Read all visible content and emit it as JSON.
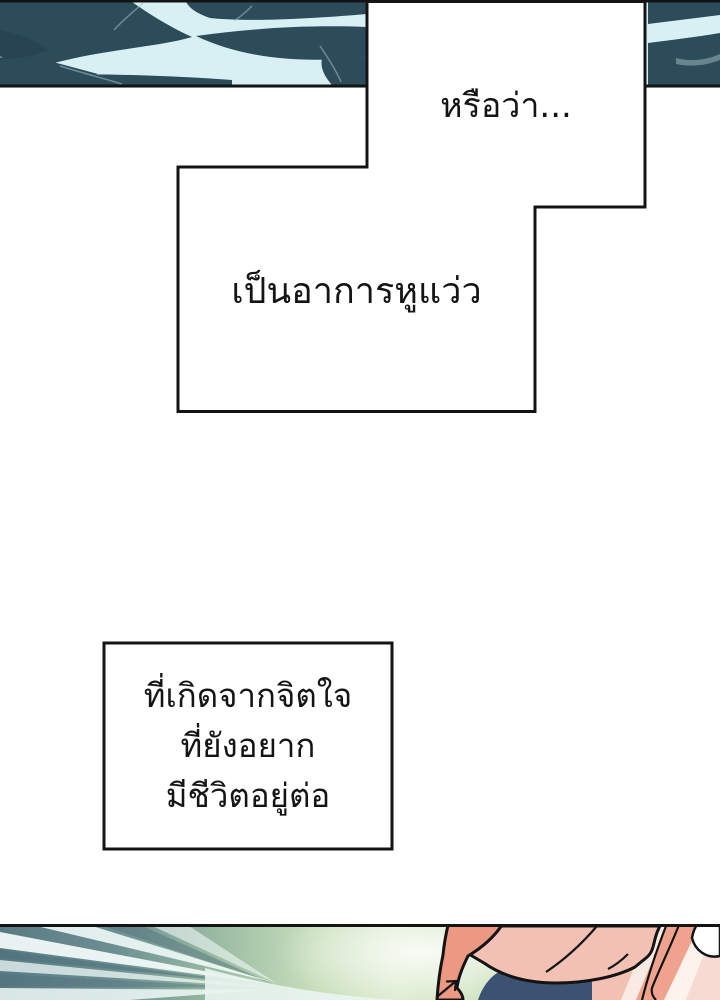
{
  "captions": [
    {
      "text": "หรือว่า..."
    },
    {
      "text": "เป็นอาการหูแว่ว"
    },
    {
      "lines": [
        "ที่เกิดจากจิตใจ",
        "ที่ยังอยาก",
        "มีชีวิตอยู่ต่อ"
      ]
    }
  ],
  "colors": {
    "ink": "#141414",
    "paper": "#ffffff",
    "water_dark": "#2d4c5a",
    "water_deep": "#24404d",
    "water_light": "#d8f0f3",
    "sea_teal": "#5d7f88",
    "sea_streak_dark": "#4d6f7a",
    "sea_ray": "#f0f9f7",
    "green_field": "#bcd7ae",
    "green_glow": "#eef6e4",
    "skin": "#ec9882",
    "shirt": "#f3c1b4",
    "pink_bg": "#f7dad1",
    "pink_stripe": "#efa28d",
    "pale_stripe": "#f9eae3",
    "navy": "#3d5270",
    "white_cloth": "#ffffff"
  }
}
